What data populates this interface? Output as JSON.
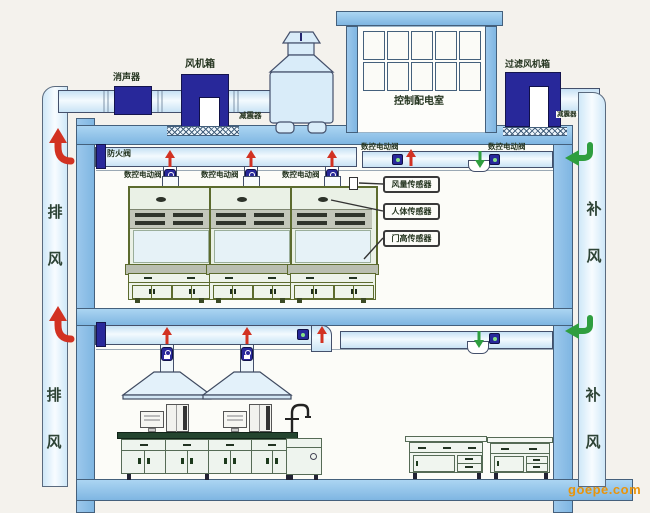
{
  "diagram": {
    "roof": {
      "silencer": "消声器",
      "fan_box": "风机箱",
      "shock_absorber_left": "减震器",
      "control_room": "控制配电室",
      "filter_fan_box": "过滤风机箱",
      "shock_absorber_right": "减震器"
    },
    "upper_floor": {
      "fire_damper": "防火阀",
      "cnc_valves": [
        "数控电动阀",
        "数控电动阀",
        "数控电动阀",
        "数控电动阀",
        "数控电动阀"
      ],
      "sensors": [
        "风量传感器",
        "人体传感器",
        "门高传感器"
      ]
    },
    "shafts": {
      "exhaust": "排风",
      "supply": "补风"
    },
    "watermark": "goepe.com",
    "colors": {
      "equipment_navy": "#28289a",
      "exhaust_red": "#d23222",
      "supply_green": "#2f9e3f",
      "structure_blue": "#8cc0e8",
      "label_text": "#24341f",
      "watermark_orange": "#e8940c"
    }
  }
}
